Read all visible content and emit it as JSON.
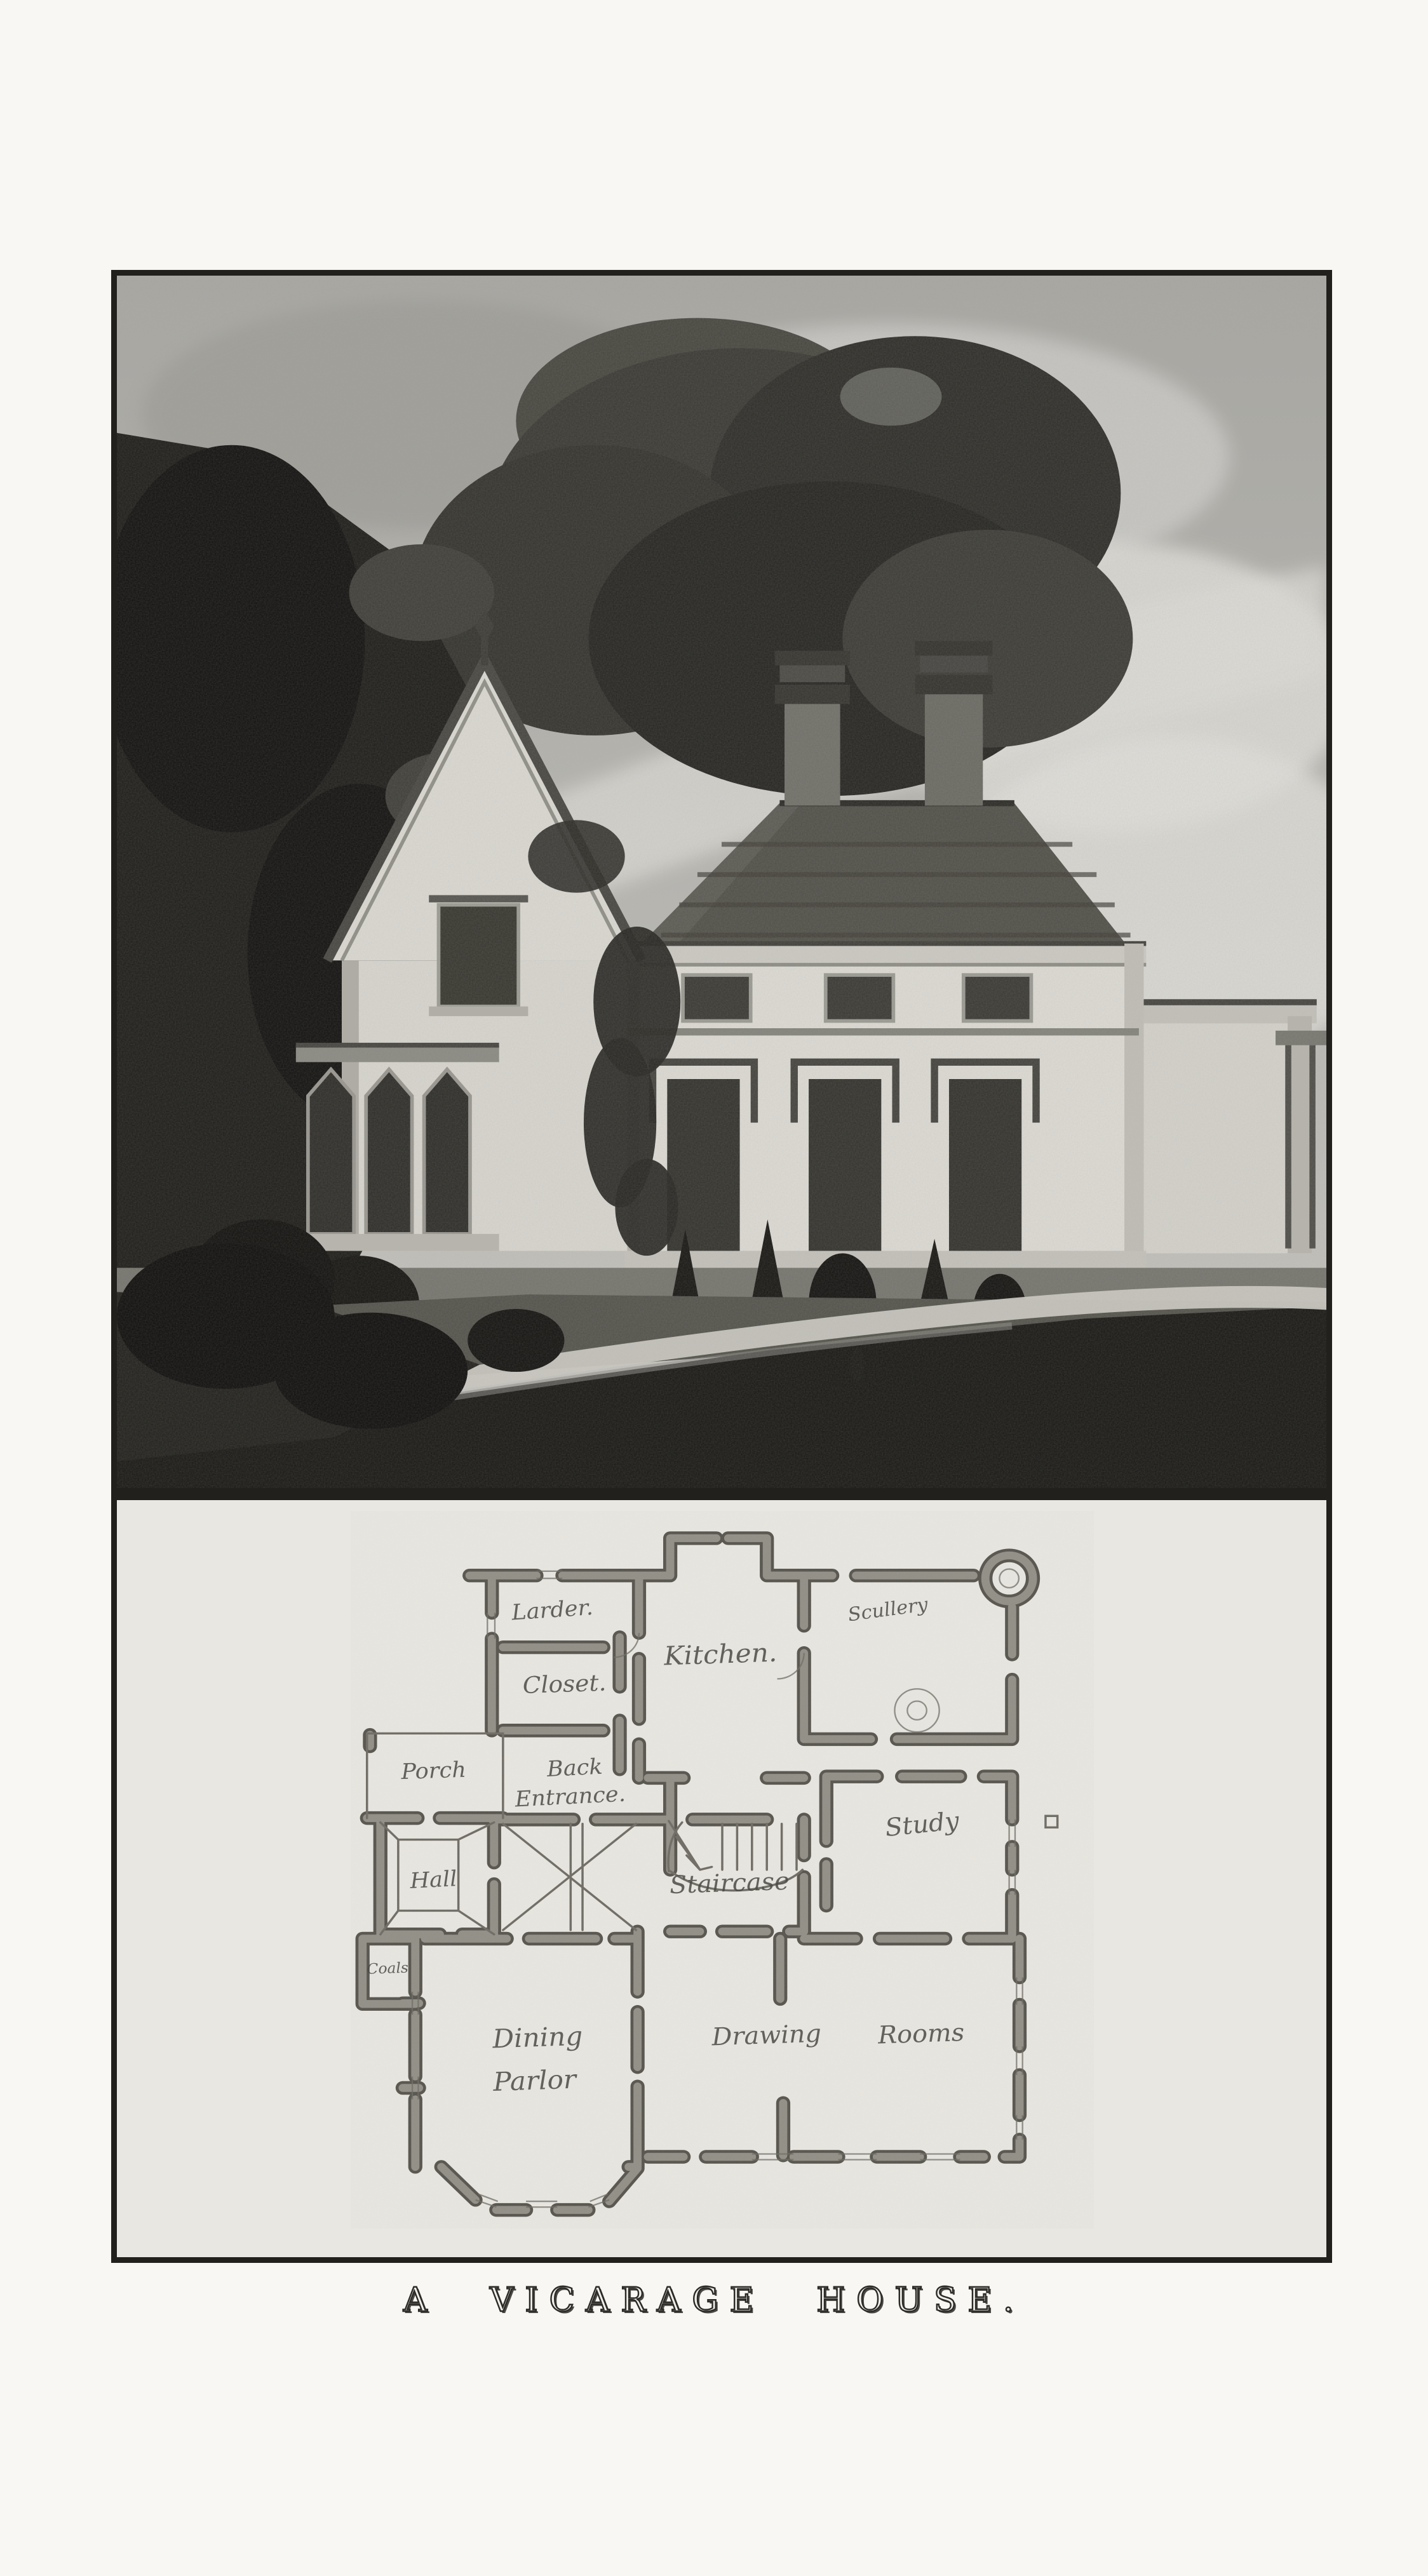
{
  "page": {
    "caption": "A VICARAGE HOUSE."
  },
  "colors": {
    "page_bg": "#f8f7f3",
    "plate_paper": "#e9e7e1",
    "frame_ink": "#21201d",
    "caption_ink": "#2b2a26",
    "plan_wall": "#918f86",
    "plan_wall_outline": "#56544d",
    "plan_line": "#6e6c64",
    "plan_ink": "#45443e",
    "sky": "#b7b6b1",
    "cloud": "#d8d7d2",
    "foliage_dark": "#1e1d1a",
    "foliage_mid": "#34332e",
    "house_wall": "#dcdad3",
    "roof": "#504f48",
    "foreground": "#191815",
    "drive": "#c9c7c0"
  },
  "floor_plan": {
    "rooms": [
      {
        "id": "larder",
        "label": "Larder."
      },
      {
        "id": "closet",
        "label": "Closet."
      },
      {
        "id": "kitchen",
        "label": "Kitchen."
      },
      {
        "id": "scullery",
        "label": "Scullery"
      },
      {
        "id": "porch",
        "label": "Porch"
      },
      {
        "id": "back-entrance",
        "label": "Back",
        "label2": "Entrance."
      },
      {
        "id": "hall",
        "label": "Hall"
      },
      {
        "id": "staircase",
        "label": "Staircase"
      },
      {
        "id": "study",
        "label": "Study"
      },
      {
        "id": "coals",
        "label": "Coals"
      },
      {
        "id": "dining-parlor",
        "label": "Dining",
        "label2": "Parlor"
      },
      {
        "id": "drawing-rooms",
        "label": "Drawing",
        "label2": "Rooms"
      }
    ]
  }
}
